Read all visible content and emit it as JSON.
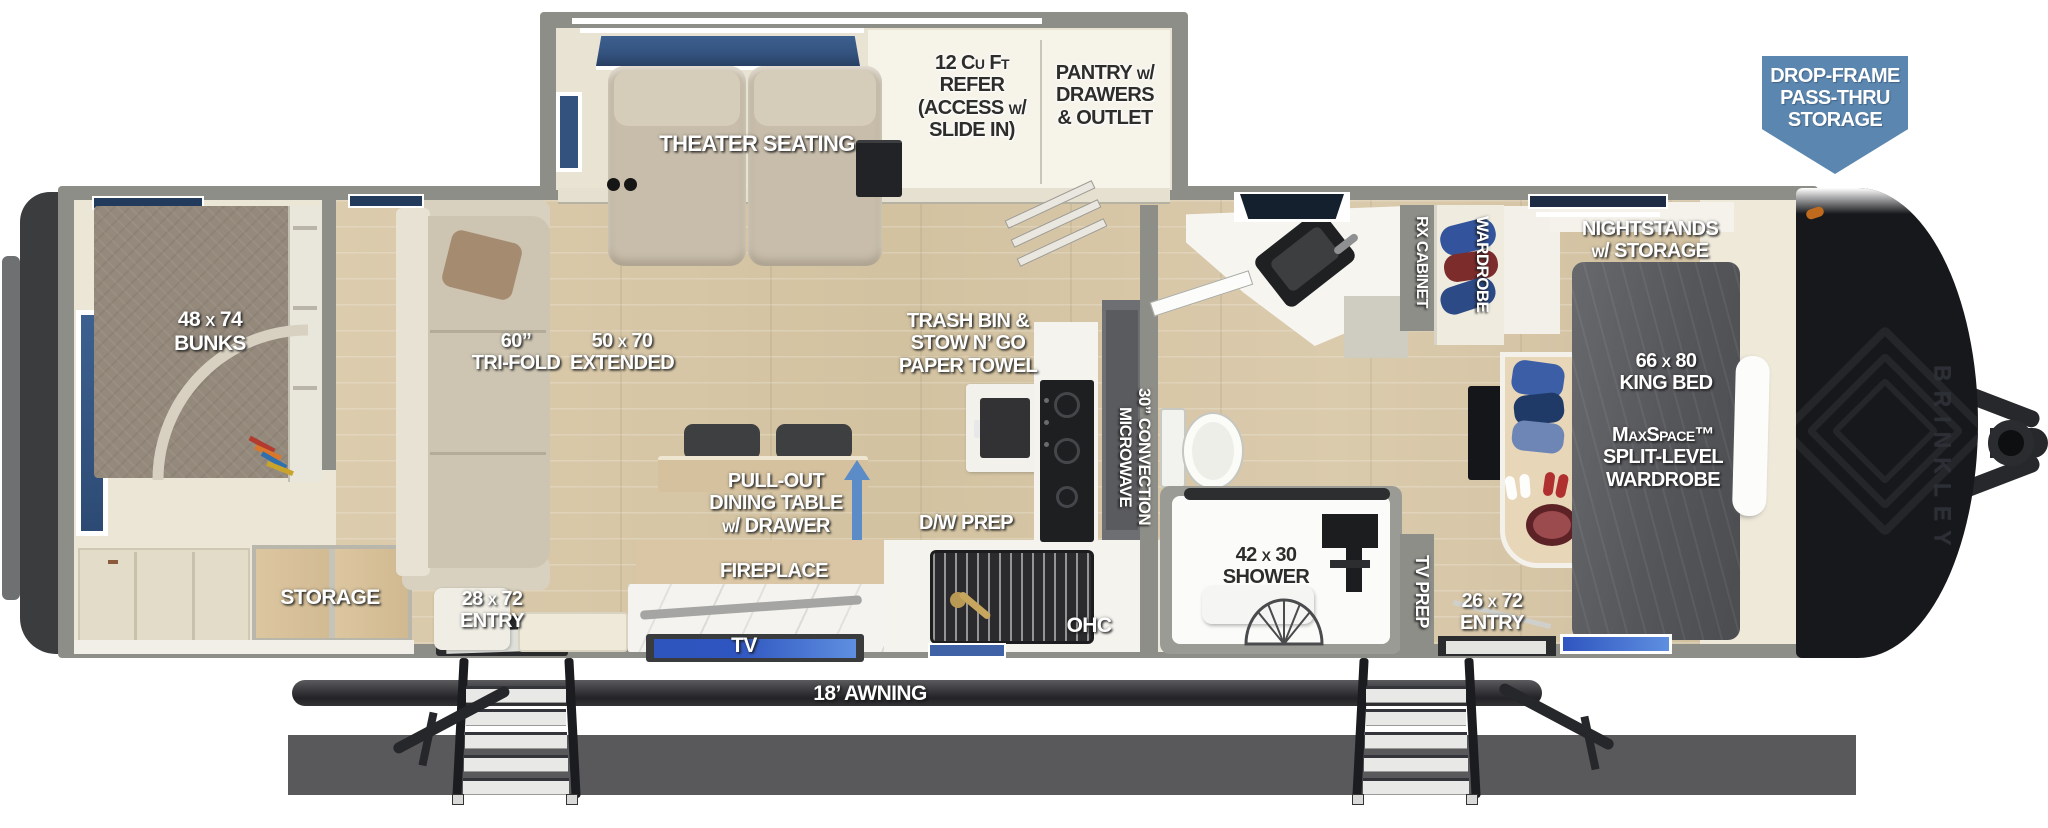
{
  "theme": {
    "wall_gray": "#8e8e89",
    "interior_cream": "#f2efe5",
    "floor_wood": "#d8c8a8",
    "callout_blue": "#5b86af",
    "arrow_blue": "#5b8cc7",
    "window_blue": "#34527e",
    "tv_blue": "#2f55c0",
    "awning_dark": "#232327",
    "front_cap_black": "#17181b",
    "rear_cap_gray": "#3a3c3e",
    "bed_gray": "#595c60",
    "bunk_taupe": "#94897b",
    "sofa_beige": "#cdc5b2",
    "shadow_gray": "#59595b"
  },
  "labels": {
    "refer": "12 Cu Ft\nREFER\n(ACCESS w/\nSLIDE IN)",
    "pantry": "PANTRY w/\nDRAWERS\n& OUTLET",
    "theater": "THEATER SEATING",
    "drop_frame": "DROP-FRAME\nPASS-THRU\nSTORAGE",
    "bunks": "48 x 74\nBUNKS",
    "tri_fold": "60”\nTRI-FOLD",
    "extended": "50 x 70\nEXTENDED",
    "trash": "TRASH BIN &\nSTOW N’ GO\nPAPER TOWEL",
    "microwave": "30” CONVECTION\nMICROWAVE",
    "dining": "PULL-OUT\nDINING TABLE\nw/ DRAWER",
    "fireplace": "FIREPLACE",
    "dw_prep": "D/W PREP",
    "tv": "TV",
    "ohc": "OHC",
    "storage": "STORAGE",
    "entry_left": "28 x 72\nENTRY",
    "shower": "42 x 30\nSHOWER",
    "tv_prep": "TV PREP",
    "entry_right": "26 x 72\nENTRY",
    "rx_cabinet": "RX CABINET",
    "wardrobe": "WARDROBE",
    "nightstands": "NIGHTSTANDS\nw/ STORAGE",
    "king_bed": "66 x 80\nKING BED",
    "maxspace": "MaxSpace™\nSPLIT-LEVEL\nWARDROBE",
    "awning": "18’ AWNING",
    "brand": "BRINKLEY"
  }
}
